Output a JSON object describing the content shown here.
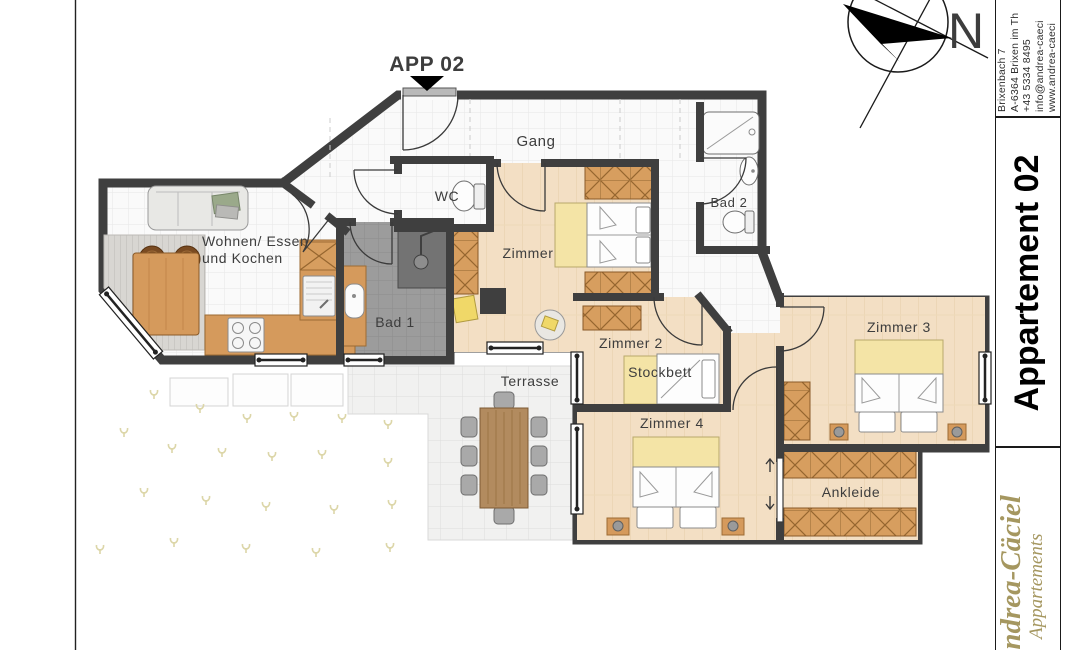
{
  "plan": {
    "title": "APP 02",
    "rooms": {
      "gang": "Gang",
      "wc": "WC",
      "wohnen_line1": "Wohnen/ Essen",
      "wohnen_line2": "und Kochen",
      "bad1": "Bad 1",
      "zimmer": "Zimmer",
      "bad2": "Bad 2",
      "zimmer2": "Zimmer 2",
      "stockbett": "Stockbett",
      "zimmer3": "Zimmer 3",
      "zimmer4": "Zimmer 4",
      "ankleide": "Ankleide",
      "terrasse": "Terrasse"
    },
    "compass_label": "N"
  },
  "sidebar": {
    "address": {
      "line1": "Brixenbach 7",
      "line2": "A-6364 Brixen im Th",
      "line3": "+43 5334 8495",
      "line4": "info@andrea-caeci",
      "line5": "www.andrea-caeci"
    },
    "apartment_title": "Appartement 02",
    "logo": {
      "name": "Andrea-Cäciel",
      "subtitle": "Appartements"
    }
  },
  "colors": {
    "wall": "#3f3f3f",
    "wood_floor": "#f3dfc4",
    "wood_furniture": "#d79e5f",
    "bath_tile": "#9c9c9c",
    "blanket_yellow": "#f4e4a6",
    "logo_gold": "#a59760"
  }
}
